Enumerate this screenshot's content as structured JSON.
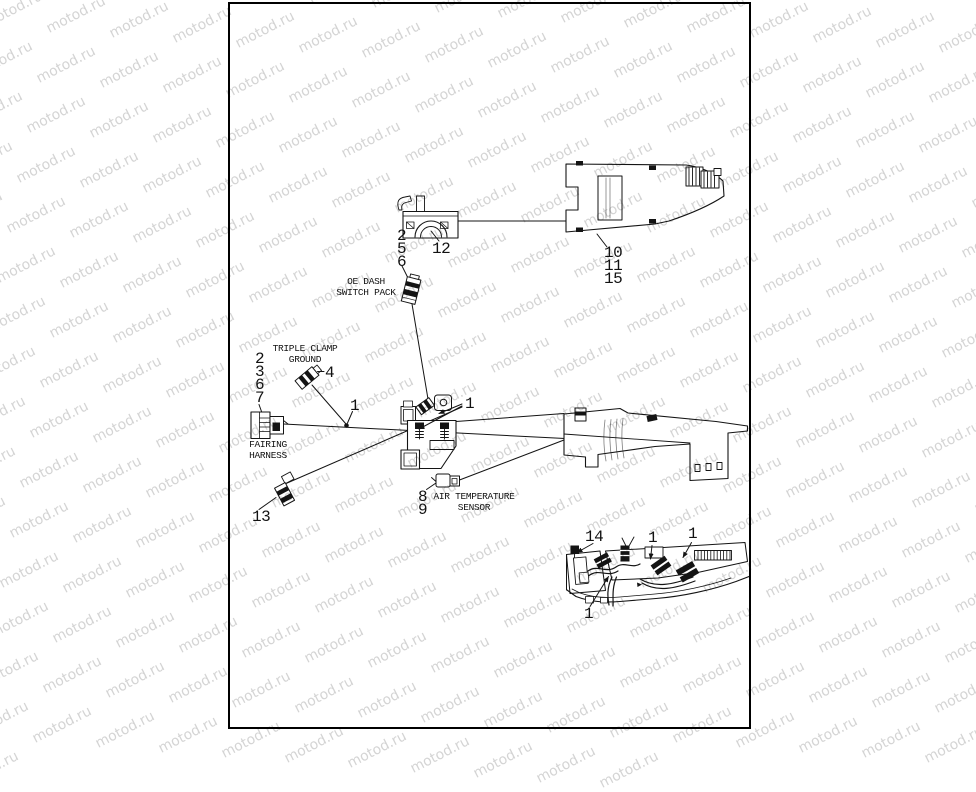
{
  "watermark": {
    "text": "motod.ru",
    "color": "#d4d4d4",
    "font_size": 14,
    "rotation_deg": -27,
    "rows": 18,
    "cols": 19,
    "col_step_x": 63,
    "col_step_y": 5,
    "row_step_x": -10,
    "row_step_y": 50,
    "origin_x": -40,
    "origin_y": -45
  },
  "diagram": {
    "callouts": {
      "clamp_items": [
        "2",
        "5",
        "6"
      ],
      "clamp_ref": "12",
      "dash_switch_caption": [
        "OE DASH",
        "SWITCH PACK"
      ],
      "nacelle_items": [
        "10",
        "11",
        "15"
      ],
      "ground_caption": [
        "TRIPLE CLAMP",
        "GROUND"
      ],
      "ground_ref": "4",
      "harness_items": [
        "2",
        "3",
        "6",
        "7"
      ],
      "harness_caption": [
        "FAIRING",
        "HARNESS"
      ],
      "splice_ref": "1",
      "bracket_ref": "1",
      "relay_ref": "13",
      "sensor_items": [
        "8",
        "9"
      ],
      "sensor_caption": [
        "AIR TEMPERATURE",
        "SENSOR"
      ],
      "lower_ref_14": "14",
      "lower_ref_1a": "1",
      "lower_ref_1b": "1",
      "lower_ref_1c": "1"
    }
  }
}
